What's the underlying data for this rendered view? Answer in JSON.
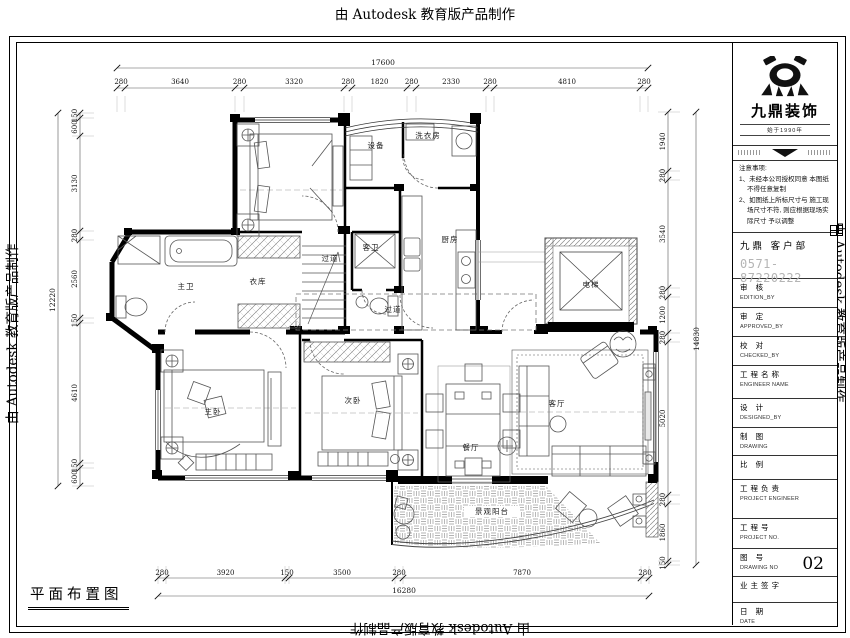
{
  "watermark": {
    "text": "由 Autodesk 教育版产品制作"
  },
  "plan_title": "平面布置图",
  "rooms": [
    {
      "id": "shebei",
      "label": "设备"
    },
    {
      "id": "xiyifang",
      "label": "洗衣房"
    },
    {
      "id": "kewei",
      "label": "客卫"
    },
    {
      "id": "chufang",
      "label": "厨房"
    },
    {
      "id": "guodao1",
      "label": "过道"
    },
    {
      "id": "guodao2",
      "label": "过道"
    },
    {
      "id": "zhuwei",
      "label": "主卫"
    },
    {
      "id": "yiku",
      "label": "衣库"
    },
    {
      "id": "zhuwo",
      "label": "主卧"
    },
    {
      "id": "ciwo",
      "label": "次卧"
    },
    {
      "id": "canting",
      "label": "餐厅"
    },
    {
      "id": "keting",
      "label": "客厅"
    },
    {
      "id": "dianti",
      "label": "电梯"
    },
    {
      "id": "yangtai",
      "label": "景观阳台"
    }
  ],
  "dimensions": {
    "top": {
      "total": "17600",
      "segments": [
        "280",
        "3640",
        "280",
        "3320",
        "280",
        "1820",
        "280",
        "2330",
        "280",
        "4810",
        "280"
      ]
    },
    "bottom": {
      "total": "16280",
      "segments": [
        "280",
        "3920",
        "150",
        "3500",
        "280",
        "7870",
        "280"
      ]
    },
    "left": {
      "total": "12220",
      "segments": [
        "150",
        "600",
        "3130",
        "280",
        "2560",
        "150",
        "4610",
        "150",
        "600"
      ]
    },
    "right": {
      "total": "14830",
      "segments": [
        "1940",
        "280",
        "3540",
        "280",
        "1200",
        "280",
        "5020",
        "280",
        "1860",
        "150"
      ]
    }
  },
  "title_block": {
    "brand": {
      "name": "九鼎装饰",
      "since": "始于1990年"
    },
    "notes": {
      "heading": "注意事项:",
      "items": [
        "1、未经本公司授权同意 本图纸不得任意复制",
        "2、如图纸上所标尺寸与 施工现场尺寸不符, 则应根据现场实际尺寸 予以调整"
      ]
    },
    "dept": "九鼎 客户部",
    "phone": "0571-87220222",
    "rows": [
      {
        "cn": "审  核",
        "en": "EDITION_BY",
        "value": ""
      },
      {
        "cn": "审  定",
        "en": "APPROVED_BY",
        "value": ""
      },
      {
        "cn": "校  对",
        "en": "CHECKED_BY",
        "value": ""
      },
      {
        "cn": "工程名称",
        "en": "ENGINEER NAME",
        "value": ""
      },
      {
        "cn": "设  计",
        "en": "DESIGNED_BY",
        "value": ""
      },
      {
        "cn": "制  图",
        "en": "DRAWING",
        "value": ""
      },
      {
        "cn": "比  例",
        "en": "",
        "value": ""
      },
      {
        "cn": "工程负责",
        "en": "PROJECT ENGINEER",
        "value": ""
      },
      {
        "cn": "工程号",
        "en": "PROJECT NO.",
        "value": ""
      },
      {
        "cn": "图  号",
        "en": "DRAWING NO",
        "value": "02"
      },
      {
        "cn": "业主签字",
        "en": "",
        "value": ""
      },
      {
        "cn": "日  期",
        "en": "DATE",
        "value": ""
      }
    ]
  }
}
